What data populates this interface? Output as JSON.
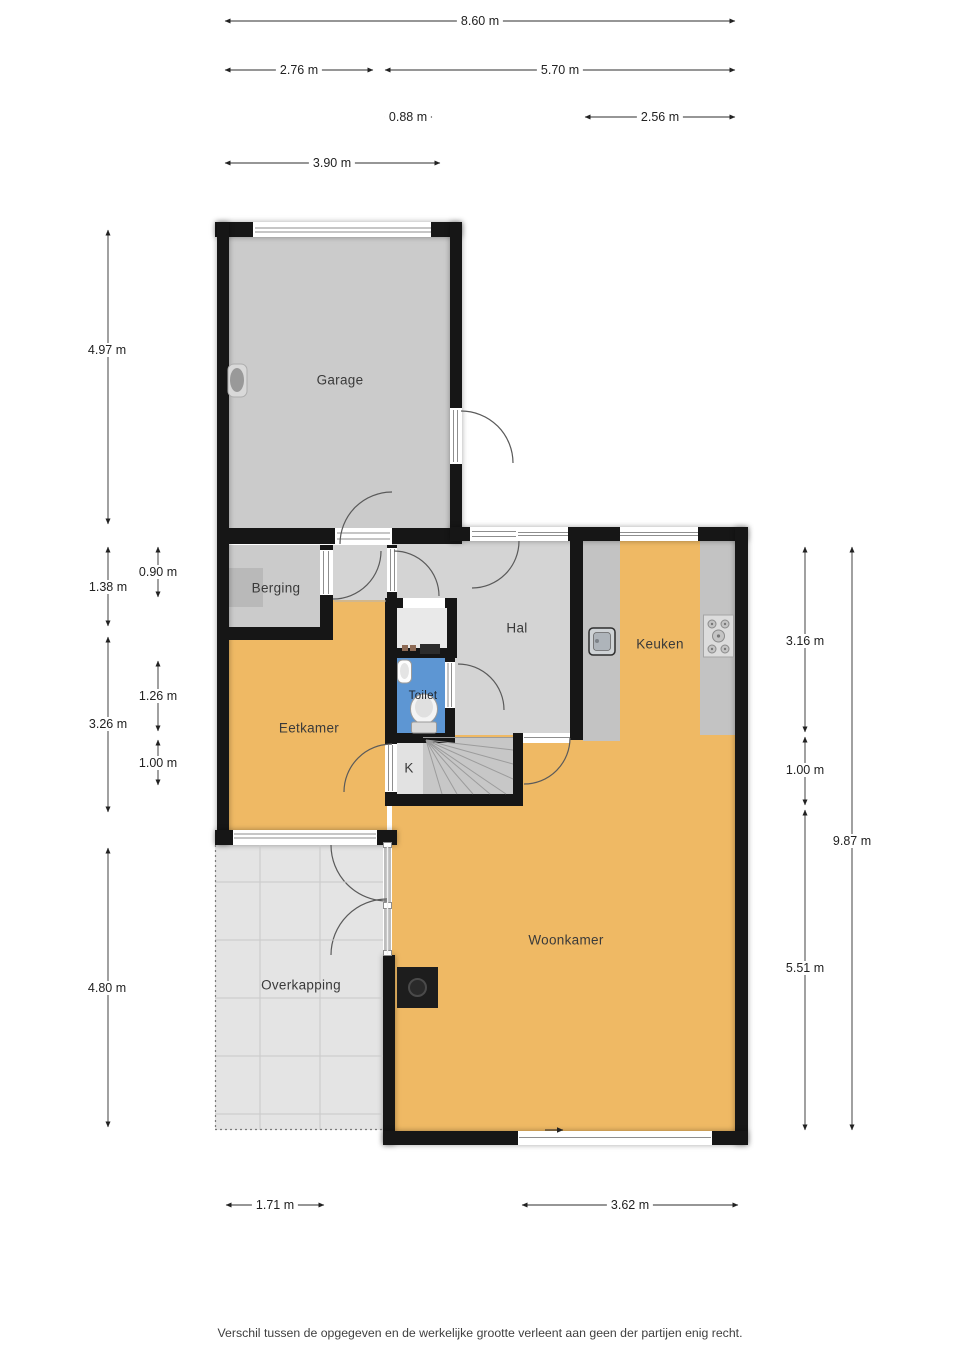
{
  "title": "Begane grond plattegrond",
  "rooms": {
    "garage": "Garage",
    "berging": "Berging",
    "hal": "Hal",
    "toilet": "Toilet",
    "keuken": "Keuken",
    "eetkamer": "Eetkamer",
    "kast": "K",
    "woonkamer": "Woonkamer",
    "overkapping": "Overkapping"
  },
  "dimensions": {
    "top": [
      {
        "label": "8.60 m"
      },
      {
        "label": "2.76 m"
      },
      {
        "label": "5.70 m"
      },
      {
        "label": "0.88 m"
      },
      {
        "label": "2.56 m"
      },
      {
        "label": "3.90 m"
      }
    ],
    "left": [
      {
        "label": "4.97 m"
      },
      {
        "label": "1.38 m"
      },
      {
        "label": "0.90 m"
      },
      {
        "label": "3.26 m"
      },
      {
        "label": "1.26 m"
      },
      {
        "label": "1.00 m"
      },
      {
        "label": "4.80 m"
      }
    ],
    "right": [
      {
        "label": "3.16 m"
      },
      {
        "label": "1.00 m"
      },
      {
        "label": "9.87 m"
      },
      {
        "label": "5.51 m"
      }
    ],
    "bottom": [
      {
        "label": "1.71 m"
      },
      {
        "label": "3.62 m"
      }
    ]
  },
  "footer": {
    "disclaimer": "Verschil tussen de opgegeven en de werkelijke grootte verleent aan geen der partijen enig recht."
  },
  "colors": {
    "wall": "#161616",
    "floor_orange": "#efb964",
    "floor_gray": "#cbcbcb",
    "hal_gray": "#d4d4d4",
    "counter_gray": "#c3c3c3",
    "stairs_gray": "#c7c7c7",
    "overkapping_gray": "#e4e4e4",
    "toilet_blue": "#5d96d3"
  }
}
